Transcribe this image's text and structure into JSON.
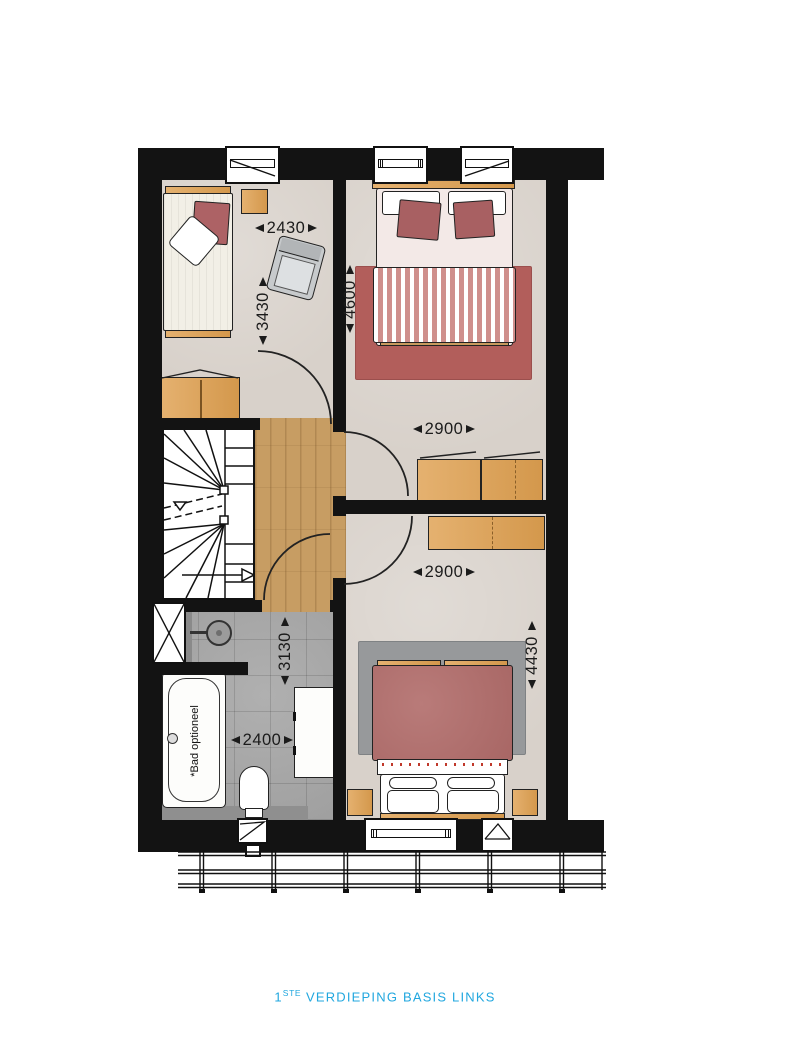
{
  "caption": {
    "number": "1",
    "ordinal": "STE",
    "title": " VERDIEPING BASIS LINKS"
  },
  "dimensions": {
    "bedroom1_width": "2430",
    "bedroom1_depth": "3430",
    "bedroom2_depth": "4600",
    "bedroom2_width": "2900",
    "bedroom3_width": "2900",
    "bedroom3_depth": "4430",
    "bathroom_depth": "3130",
    "bathroom_width": "2400"
  },
  "labels": {
    "bath_optional": "*Bad optioneel"
  },
  "colors": {
    "caption_accent": "#21a7df",
    "wall": "#131313",
    "bedroom_floor": "#d8d1ca",
    "wood_floor": "#c79d63",
    "tile_floor": "#a7a7a7",
    "rug_red": "#b25e5b",
    "rug_gray": "#97999b",
    "bed_red": "#b16c6a",
    "cushion_red": "#a86062",
    "duvet_stripe": "#cf8f8c",
    "furniture_wood": "#dfa050"
  }
}
